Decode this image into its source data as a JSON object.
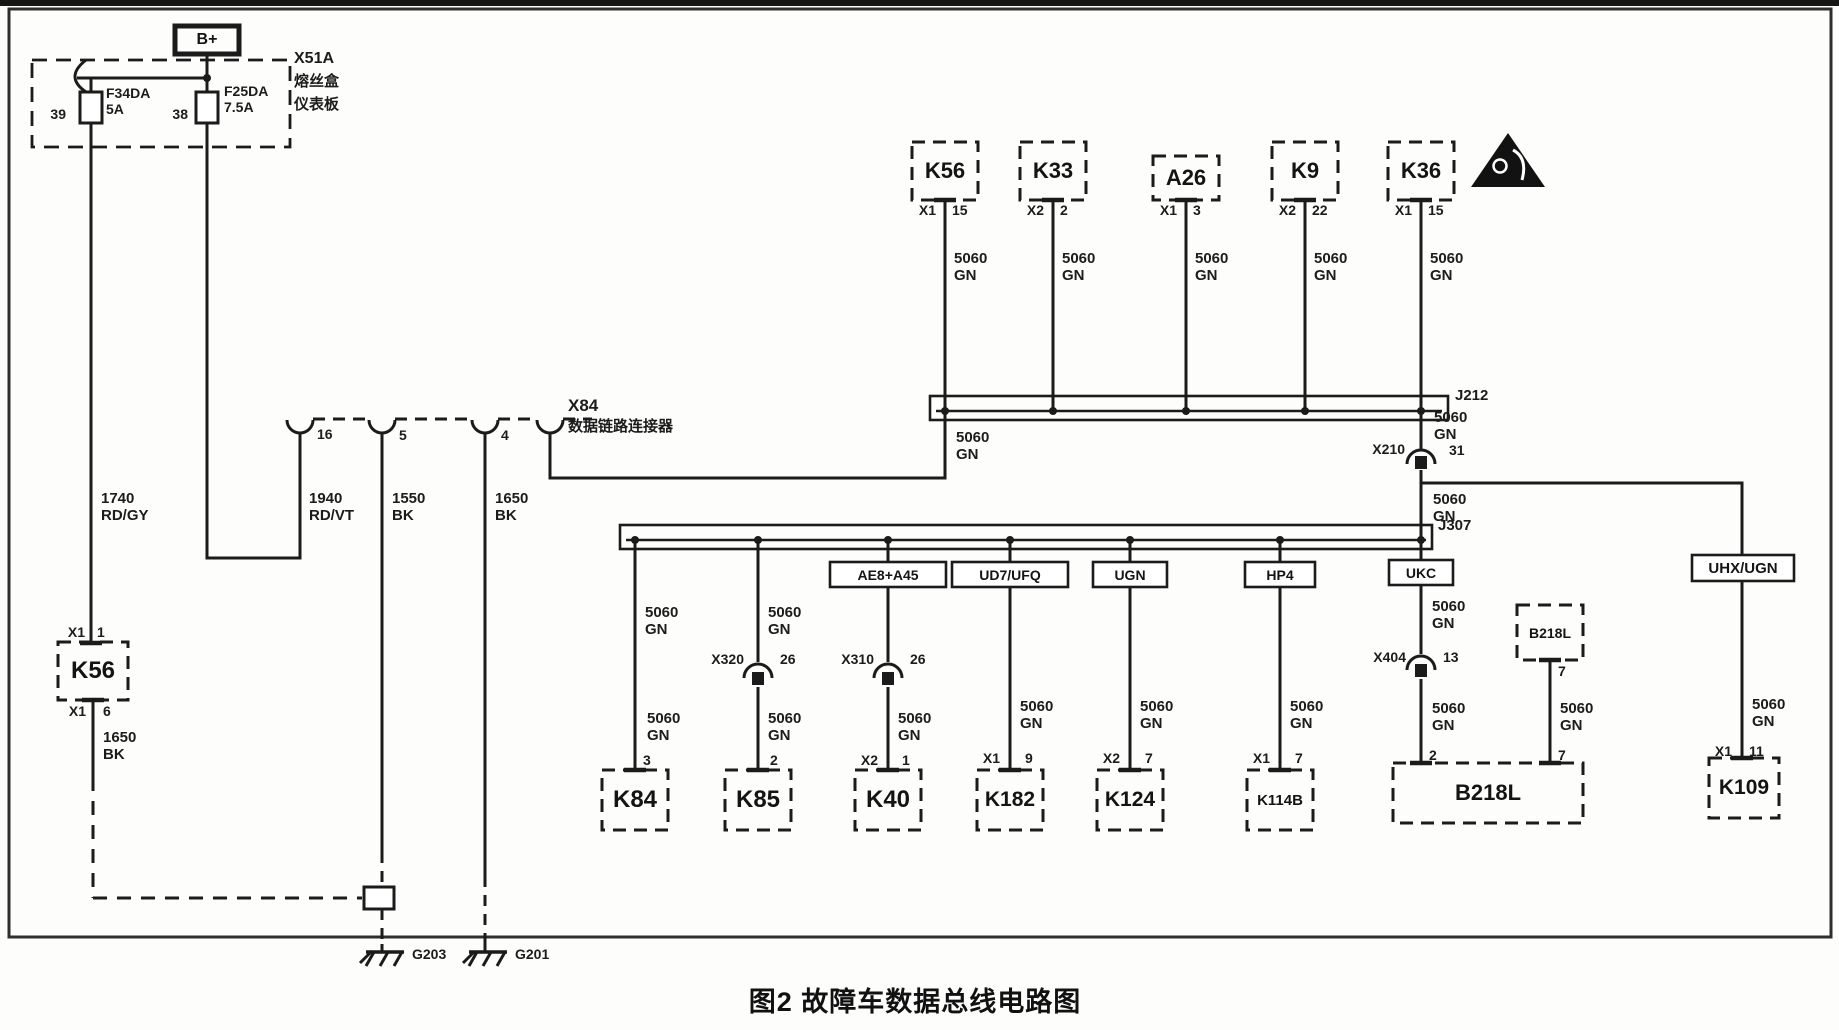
{
  "figure": {
    "title": "图2 故障车数据总线电路图"
  },
  "colors": {
    "line": "#1b1b1b",
    "background": "#ffffff"
  },
  "power": {
    "label": "B+"
  },
  "fusebox": {
    "id": "X51A",
    "desc1": "熔丝盒",
    "desc2": "仪表板",
    "fuse1_label": "F34DA 5A",
    "fuse1_pin": "39",
    "fuse2_label": "F25DA 7.5A",
    "fuse2_pin": "38"
  },
  "dlc": {
    "id": "X84",
    "name": "数据链路连接器",
    "pin1": "16",
    "pin2": "5",
    "pin3": "4"
  },
  "left_k56": {
    "id": "K56",
    "conn_top": "X1",
    "pin_top": "1",
    "conn_bot": "X1",
    "pin_bot": "6"
  },
  "grounds": {
    "g203": "G203",
    "g201": "G201"
  },
  "wires": {
    "bus": "5060 GN",
    "w1740": "1740 RD/GY",
    "w1940": "1940 RD/VT",
    "w1550": "1550 BK",
    "w1650": "1650 BK"
  },
  "buses": {
    "j212": "J212",
    "j307": "J307"
  },
  "connectors": {
    "x210": {
      "id": "X210",
      "pin": "31"
    },
    "x320": {
      "id": "X320",
      "pin": "26"
    },
    "x310": {
      "id": "X310",
      "pin": "26"
    },
    "x404": {
      "id": "X404",
      "pin": "13"
    }
  },
  "top_modules": [
    {
      "id": "K56",
      "conn": "X1",
      "pin": "15"
    },
    {
      "id": "K33",
      "conn": "X2",
      "pin": "2"
    },
    {
      "id": "A26",
      "conn": "X1",
      "pin": "3"
    },
    {
      "id": "K9",
      "conn": "X2",
      "pin": "22"
    },
    {
      "id": "K36",
      "conn": "X1",
      "pin": "15"
    }
  ],
  "tags": {
    "ae8": "AE8+A45",
    "ud7": "UD7/UFQ",
    "ugn": "UGN",
    "hp4": "HP4",
    "ukc": "UKC",
    "uhx": "UHX/UGN"
  },
  "bottom_modules": [
    {
      "id": "K84",
      "pin": "3"
    },
    {
      "id": "K85",
      "pin": "2"
    },
    {
      "id": "K40",
      "conn": "X2",
      "pin": "1"
    },
    {
      "id": "K182",
      "conn": "X1",
      "pin": "9"
    },
    {
      "id": "K124",
      "conn": "X2",
      "pin": "7"
    },
    {
      "id": "K114B",
      "conn": "X1",
      "pin": "7"
    },
    {
      "id": "K109",
      "conn": "X1",
      "pin": "11"
    }
  ],
  "b218l": {
    "id": "B218L",
    "pin_left": "2",
    "pin_right": "7",
    "small_id": "B218L",
    "small_pin": "7"
  }
}
